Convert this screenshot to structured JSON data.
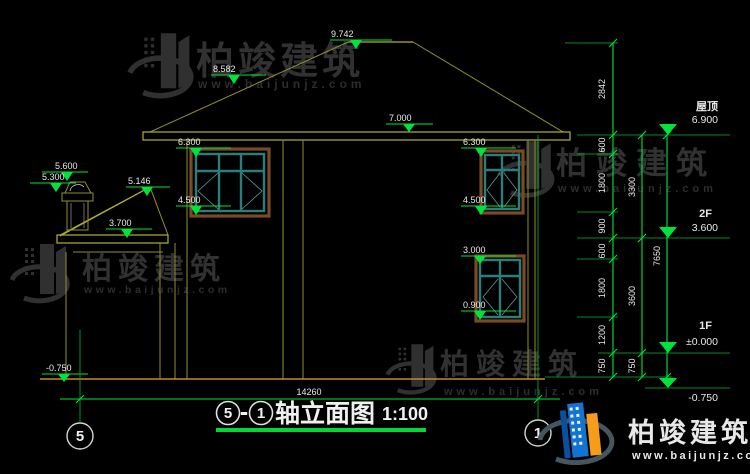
{
  "watermark": {
    "brand": "柏竣建筑",
    "site": "www.baijunjz.com"
  },
  "marks": {
    "peak": "9.742",
    "slope": "8.582",
    "eave": "7.000",
    "w2l_top": "6.300",
    "w2l_sill": "4.500",
    "w2r_top": "6.300",
    "w2r_sill": "4.500",
    "w1r_top": "3.000",
    "w1r_sill": "0.900",
    "chim_top": "5.600",
    "chim_cap": "5.300",
    "porch_peak": "5.146",
    "porch_eave": "3.700",
    "ground_left": "-0.750"
  },
  "levels": {
    "roof_label": "屋顶",
    "roof_elev": "6.900",
    "f2_label": "2F",
    "f2_elev": "3.600",
    "f1_label": "1F",
    "f1_elev": "±0.000",
    "base_elev": "-0.750"
  },
  "chains": {
    "a": [
      "2842",
      "600",
      "1800",
      "900",
      "600",
      "1800",
      "1200",
      "750"
    ],
    "b": [
      "3300",
      "3600",
      "750"
    ],
    "c": [
      "7650"
    ],
    "total_width": "14260"
  },
  "axes": {
    "left": "5",
    "right": "1"
  },
  "title": {
    "from": "5",
    "dash": "-",
    "to": "1",
    "name": "轴立面图",
    "scale": "1:100"
  },
  "colors": {
    "dim_green": "#00e33c",
    "cad_yellow": "#b0b036",
    "ground_orange": "#c8882a",
    "window_teal": "#2e7d7d",
    "frame_brown": "#7a4a22",
    "logo_blue": "#1273d2",
    "logo_orange": "#f59c1b"
  }
}
